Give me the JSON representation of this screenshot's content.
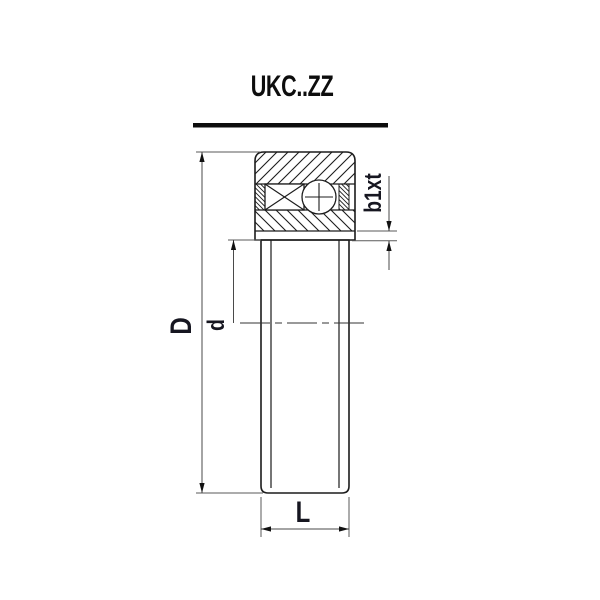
{
  "title": "UKC..ZZ",
  "labels": {
    "outer_diameter": "D",
    "bore_diameter": "d",
    "width": "L",
    "groove": "b1xt"
  },
  "colors": {
    "background": "#ffffff",
    "part_line": "#1c1c1c",
    "dimension_line": "#4a4a4a",
    "text": "#161620"
  },
  "drawing": {
    "type": "bearing-cross-section",
    "elements": [
      "outer-ring",
      "cage",
      "ball",
      "shield-strips",
      "inner-sleeve",
      "centerline"
    ]
  }
}
